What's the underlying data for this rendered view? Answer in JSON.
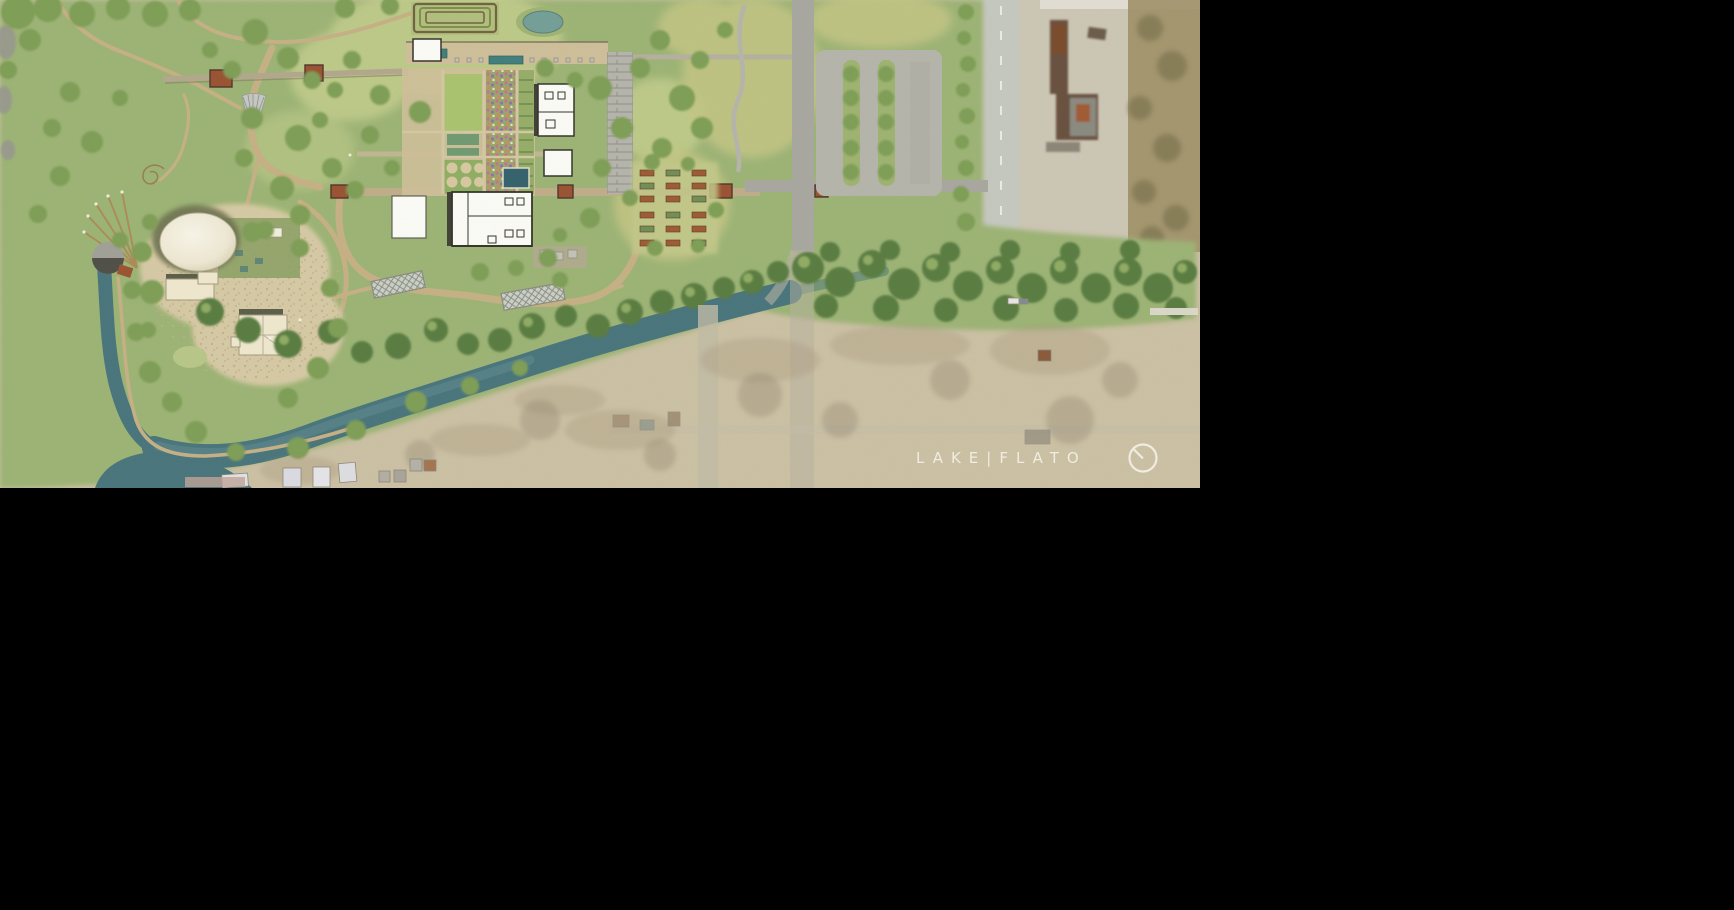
{
  "logo": {
    "text": "LAKE|FLATO",
    "color": "#f2efe4"
  },
  "palette": {
    "aerial": "#ccc1a4",
    "aerialPale": "#cdc7b5",
    "scrub": "#a09066",
    "parkGreen": "#9cb474",
    "meadowLight": "#c3ce8c",
    "fieldYellow": "#c4c684",
    "lawn": "#a9c46e",
    "treeMid": "#7e9e55",
    "treeDark": "#678a49",
    "treeDeep": "#597c41",
    "creek": "#47747c",
    "creekLight": "#5e8b90",
    "path": "#c6b184",
    "walkTan": "#cfc09a",
    "plaza": "#d7caa5",
    "stone": "#b5b5ac",
    "road": "#a8a8a0",
    "roadPale": "#c6c9c0",
    "rust": "#9a5230",
    "white_roof": "#fdfdf9",
    "cream_roof": "#f0e9cf",
    "outline": "#32322a",
    "pool": "#33616d",
    "flowerPink": "#c47390",
    "flowerPurple": "#8e72ae",
    "flowerOrange": "#cf8a5a"
  }
}
